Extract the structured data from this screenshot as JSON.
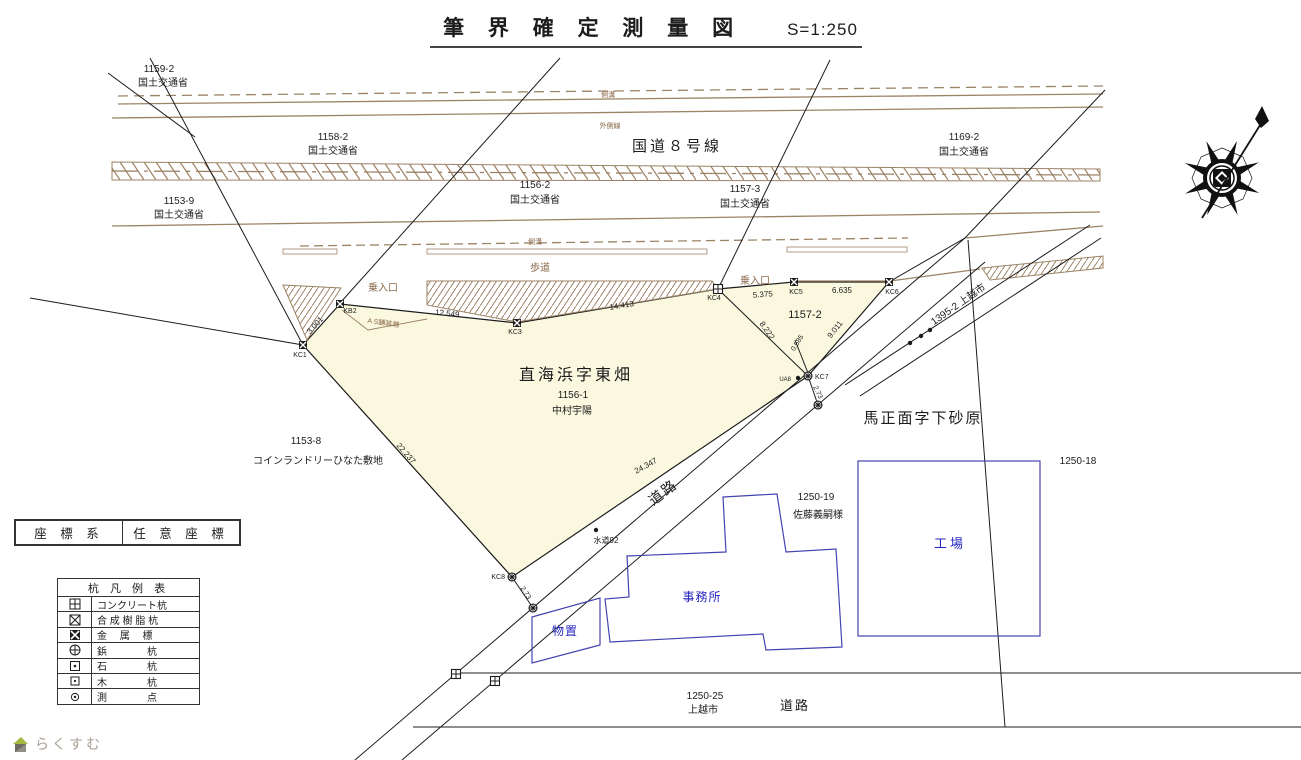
{
  "title": {
    "main": "筆 界 確 定 測 量 図",
    "scale": "S=1:250"
  },
  "coord_box": {
    "left": "座 標 系",
    "right": "任 意 座 標"
  },
  "legend": {
    "title": "杭 凡 例 表",
    "rows": [
      {
        "icon": "concrete-stake-icon",
        "label": "コンクリート杭"
      },
      {
        "icon": "resin-stake-icon",
        "label": "合 成 樹 脂 杭"
      },
      {
        "icon": "metal-marker-icon",
        "label": "金　 属　 標"
      },
      {
        "icon": "rivet-stake-icon",
        "label": "鋲　　　　杭"
      },
      {
        "icon": "stone-stake-icon",
        "label": "石　　　　杭"
      },
      {
        "icon": "wood-stake-icon",
        "label": "木　　　　杭"
      },
      {
        "icon": "survey-point-icon",
        "label": "測　　　　点"
      }
    ]
  },
  "logo": {
    "text": "らくすむ",
    "icon": "house-icon"
  },
  "colors": {
    "k": "#1c1c1c",
    "b": "#8a6848",
    "bl": "#2424c0",
    "gr": "#a8a193",
    "road_brown": "#9c8366",
    "parcel_yellow": "#fbf8e0",
    "building_blue": "#4444b0"
  },
  "map": {
    "labels": [
      {
        "name": "lot-1159-2",
        "text": "1159-2",
        "x": 159,
        "y": 72,
        "s": 10
      },
      {
        "name": "owner-1159-2",
        "text": "国土交通省",
        "x": 163,
        "y": 86,
        "s": 10
      },
      {
        "name": "lot-1158-2",
        "text": "1158-2",
        "x": 333,
        "y": 140,
        "s": 10
      },
      {
        "name": "owner-1158-2",
        "text": "国土交通省",
        "x": 333,
        "y": 154,
        "s": 10
      },
      {
        "name": "lot-1153-9",
        "text": "1153-9",
        "x": 179,
        "y": 204,
        "s": 10
      },
      {
        "name": "owner-1153-9",
        "text": "国土交通省",
        "x": 179,
        "y": 218,
        "s": 10
      },
      {
        "name": "lot-1156-2",
        "text": "1156-2",
        "x": 535,
        "y": 188,
        "s": 10
      },
      {
        "name": "owner-1156-2",
        "text": "国土交通省",
        "x": 535,
        "y": 203,
        "s": 10
      },
      {
        "name": "route8-label",
        "text": "国道８号線",
        "x": 677,
        "y": 151,
        "s": 15,
        "ls": 3
      },
      {
        "name": "lot-1157-3",
        "text": "1157-3",
        "x": 745,
        "y": 192,
        "s": 10
      },
      {
        "name": "owner-1157-3",
        "text": "国土交通省",
        "x": 745,
        "y": 207,
        "s": 10
      },
      {
        "name": "lot-1169-2",
        "text": "1169-2",
        "x": 964,
        "y": 140,
        "s": 10
      },
      {
        "name": "owner-1169-2",
        "text": "国土交通省",
        "x": 964,
        "y": 155,
        "s": 10
      },
      {
        "name": "gutter-label-top",
        "text": "側溝",
        "x": 608,
        "y": 97,
        "s": 7,
        "c": "b"
      },
      {
        "name": "outer-line-label",
        "text": "外側線",
        "x": 610,
        "y": 128,
        "s": 7,
        "c": "b"
      },
      {
        "name": "gutter-label-lower",
        "text": "側溝",
        "x": 535,
        "y": 244,
        "s": 7,
        "c": "b"
      },
      {
        "name": "sidewalk-label",
        "text": "歩道",
        "x": 540,
        "y": 271,
        "s": 10,
        "c": "b"
      },
      {
        "name": "driveway-label-left",
        "text": "乗入口",
        "x": 383,
        "y": 291,
        "s": 10,
        "c": "b"
      },
      {
        "name": "driveway-label-right",
        "text": "乗入口",
        "x": 755,
        "y": 284,
        "s": 10,
        "c": "b"
      },
      {
        "name": "pavement-edge-label",
        "text": "A S舗装端",
        "x": 383,
        "y": 325,
        "s": 7,
        "c": "b",
        "r": 8
      },
      {
        "name": "pt-label-kc1",
        "text": "KC1",
        "x": 300,
        "y": 357,
        "s": 7
      },
      {
        "name": "pt-label-kb2",
        "text": "KB2",
        "x": 350,
        "y": 313,
        "s": 7
      },
      {
        "name": "pt-label-kc3",
        "text": "KC3",
        "x": 515,
        "y": 334,
        "s": 7
      },
      {
        "name": "pt-label-kc4",
        "text": "KC4",
        "x": 714,
        "y": 300,
        "s": 7
      },
      {
        "name": "pt-label-kc5",
        "text": "KC5",
        "x": 796,
        "y": 294,
        "s": 7
      },
      {
        "name": "pt-label-kc6",
        "text": "KC6",
        "x": 892,
        "y": 294,
        "s": 7
      },
      {
        "name": "pt-label-kc7",
        "text": "KC7",
        "x": 815,
        "y": 379,
        "s": 7,
        "a": "s"
      },
      {
        "name": "pt-label-ua8",
        "text": "UA8",
        "x": 791,
        "y": 381,
        "s": 6,
        "a": "e"
      },
      {
        "name": "pt-label-kc8",
        "text": "KC8",
        "x": 505,
        "y": 579,
        "s": 7,
        "a": "e"
      },
      {
        "name": "meas-3001",
        "text": "3.001",
        "x": 317,
        "y": 327,
        "s": 8,
        "r": -48
      },
      {
        "name": "meas-12549",
        "text": "12.549",
        "x": 447,
        "y": 316,
        "s": 8,
        "r": 6
      },
      {
        "name": "meas-14413",
        "text": "14.413",
        "x": 622,
        "y": 308,
        "s": 8,
        "r": -9
      },
      {
        "name": "meas-5375",
        "text": "5.375",
        "x": 763,
        "y": 297,
        "s": 8,
        "r": -4
      },
      {
        "name": "meas-6635",
        "text": "6.635",
        "x": 842,
        "y": 293,
        "s": 8
      },
      {
        "name": "meas-8222",
        "text": "8.222",
        "x": 765,
        "y": 332,
        "s": 8,
        "r": 55
      },
      {
        "name": "meas-9011",
        "text": "9.011",
        "x": 837,
        "y": 331,
        "s": 8,
        "r": -52
      },
      {
        "name": "meas-0585",
        "text": "0.585",
        "x": 799,
        "y": 344,
        "s": 7,
        "r": -58
      },
      {
        "name": "meas-273-a",
        "text": "2.73",
        "x": 816,
        "y": 393,
        "s": 7,
        "r": 65
      },
      {
        "name": "meas-273-b",
        "text": "2.73",
        "x": 524,
        "y": 594,
        "s": 7,
        "r": 57
      },
      {
        "name": "meas-22237",
        "text": "22.237",
        "x": 404,
        "y": 455,
        "s": 8,
        "r": 49
      },
      {
        "name": "meas-24347",
        "text": "24.347",
        "x": 647,
        "y": 468,
        "s": 8,
        "r": -29
      },
      {
        "name": "parcel-name-main",
        "text": "直海浜字東畑",
        "x": 576,
        "y": 380,
        "s": 16,
        "ls": 3
      },
      {
        "name": "lot-1156-1",
        "text": "1156-1",
        "x": 573,
        "y": 398,
        "s": 10
      },
      {
        "name": "owner-nakamura",
        "text": "中村宇陽",
        "x": 572,
        "y": 414,
        "s": 10
      },
      {
        "name": "lot-1157-2",
        "text": "1157-2",
        "x": 805,
        "y": 318,
        "s": 11
      },
      {
        "name": "road-1395-2",
        "text": "1395-2 上越市",
        "x": 960,
        "y": 307,
        "s": 10,
        "r": -35
      },
      {
        "name": "area-name-right",
        "text": "馬正面字下砂原",
        "x": 923,
        "y": 423,
        "s": 15,
        "ls": 2
      },
      {
        "name": "lot-1250-18",
        "text": "1250-18",
        "x": 1078,
        "y": 464,
        "s": 10
      },
      {
        "name": "lot-1153-8",
        "text": "1153-8",
        "x": 306,
        "y": 444,
        "s": 10
      },
      {
        "name": "laundry-site-label",
        "text": "コインランドリーひなた敷地",
        "x": 318,
        "y": 464,
        "s": 10
      },
      {
        "name": "lot-1250-19",
        "text": "1250-19",
        "x": 816,
        "y": 500,
        "s": 10
      },
      {
        "name": "owner-sato",
        "text": "佐藤義嗣様",
        "x": 818,
        "y": 518,
        "s": 10
      },
      {
        "name": "building-label-factory",
        "text": "工場",
        "x": 950,
        "y": 548,
        "s": 13,
        "c": "bl",
        "ls": 3
      },
      {
        "name": "building-label-office",
        "text": "事務所",
        "x": 702,
        "y": 601,
        "s": 12,
        "c": "bl",
        "ls": 1
      },
      {
        "name": "building-label-shed",
        "text": "物置",
        "x": 565,
        "y": 635,
        "s": 12,
        "c": "bl",
        "ls": 1
      },
      {
        "name": "water-label",
        "text": "水道92",
        "x": 606,
        "y": 543,
        "s": 8
      },
      {
        "name": "road-label-diagonal",
        "text": "道路",
        "x": 666,
        "y": 496,
        "s": 14,
        "r": -38,
        "ls": 2
      },
      {
        "name": "lot-1250-25",
        "text": "1250-25",
        "x": 705,
        "y": 699,
        "s": 10
      },
      {
        "name": "owner-joetsu-city",
        "text": "上越市",
        "x": 703,
        "y": 713,
        "s": 10
      },
      {
        "name": "road-label-bottom",
        "text": "道路",
        "x": 795,
        "y": 710,
        "s": 13,
        "ls": 2
      }
    ],
    "points": [
      {
        "name": "point-kc1",
        "sym": "metal",
        "x": 303,
        "y": 345
      },
      {
        "name": "point-kb2",
        "sym": "metal",
        "x": 340,
        "y": 304
      },
      {
        "name": "point-kc3",
        "sym": "metal",
        "x": 517,
        "y": 323
      },
      {
        "name": "point-kc4",
        "sym": "sqcross",
        "x": 718,
        "y": 289
      },
      {
        "name": "point-kc5",
        "sym": "metal",
        "x": 794,
        "y": 282
      },
      {
        "name": "point-kc6",
        "sym": "metal",
        "x": 889,
        "y": 282
      },
      {
        "name": "point-kc7",
        "sym": "circx",
        "x": 808,
        "y": 376
      },
      {
        "name": "point-ua8",
        "sym": "dot",
        "x": 798,
        "y": 378
      },
      {
        "name": "point-kc8",
        "sym": "circx",
        "x": 512,
        "y": 577
      },
      {
        "name": "point-offset-kc7",
        "sym": "circx",
        "x": 818,
        "y": 405
      },
      {
        "name": "point-offset-kc8",
        "sym": "circx",
        "x": 533,
        "y": 608
      },
      {
        "name": "point-bottom-1",
        "sym": "sqcross",
        "x": 456,
        "y": 674
      },
      {
        "name": "point-bottom-2",
        "sym": "sqcross",
        "x": 495,
        "y": 681
      },
      {
        "name": "point-strip-1",
        "sym": "dot",
        "x": 910,
        "y": 343
      },
      {
        "name": "point-strip-2",
        "sym": "dot",
        "x": 921,
        "y": 336
      },
      {
        "name": "point-strip-3",
        "sym": "dot",
        "x": 930,
        "y": 330
      },
      {
        "name": "point-water",
        "sym": "dot",
        "x": 596,
        "y": 530
      }
    ]
  }
}
